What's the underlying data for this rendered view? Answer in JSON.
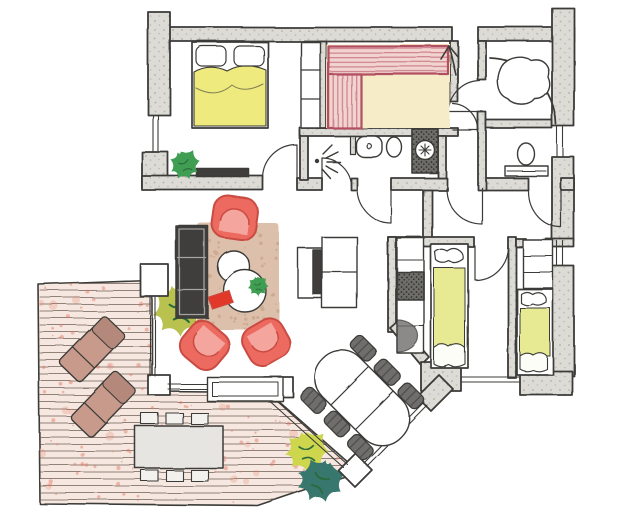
{
  "figure": {
    "kind": "hand-drawn apartment floor plan",
    "style": "pencil sketch with colored-pencil furniture, no text labels"
  },
  "palette": {
    "paper": "#ffffff",
    "ink": "#3b3a38",
    "wallFill": "#dcdbd6",
    "wallDot": "#b9b7b0",
    "bedYellow": "#eeea7d",
    "kidsBedYellow": "#e7ea93",
    "blanketWhite": "#fdfdf8",
    "saunaEdge": "#b24f63",
    "saunaBench": "#f0d4cd",
    "saunaStripe": "#cf8090",
    "saunaFloor": "#f7ecc8",
    "chairRed": "#ec6a5f",
    "chairRedDark": "#c94b42",
    "chairSeat": "#f4a9a0",
    "rug": "#dcc0ab",
    "rugSpeck": "#c19a7f",
    "tvDark": "#3f3e3c",
    "tvLine": "#a5a49f",
    "deckTint": "#f6e8e0",
    "deckLine": "#6f6057",
    "deckSpeck": "#e2735f",
    "loungerFill": "#c89a8b",
    "loungerDark": "#b5887b",
    "outTable": "#e6e5e1",
    "outChair": "#f2f1ed",
    "diningChair": "#6f6e6c",
    "plantGreen": "#3f9e52",
    "plantOlive": "#b9c24f",
    "plantTeal": "#39776d",
    "plantYellow": "#cdd64e",
    "plantDark": "#2c6b3c",
    "bookRed": "#e2382c",
    "hatchDark": "#6e6d69",
    "hatchDot": "#2f2e2c"
  },
  "deck": {
    "plank_spacing": 7,
    "plank_top": 283,
    "plank_bottom": 503,
    "plank_left": 40,
    "plank_right": 358,
    "speck_count": 240,
    "seed": 11
  },
  "rug": {
    "x": 197,
    "y": 223,
    "w": 82,
    "h": 106,
    "speck_count": 90,
    "seed": 5
  },
  "objects": [
    "double-bed",
    "bedroom-wardrobe-shelf",
    "bedroom-plant",
    "bedroom-sideboard",
    "sauna-bench-top",
    "sauna-bench-left",
    "sauna-floor",
    "shower-head",
    "washbasin",
    "toilet",
    "washing-machine",
    "corner-bathtub",
    "wc-toilet",
    "entrance-arrow",
    "hall-cabinet",
    "tv-sideboard",
    "living-rug",
    "coffee-tables",
    "red-book",
    "table-plant",
    "armchair-top",
    "armchair-left",
    "armchair-right",
    "window-bench",
    "dining-table",
    "dining-chairs",
    "kids-wardrobe",
    "kids-bed-1",
    "kids-bed-2",
    "kids-shelf",
    "terrace-deck",
    "sun-lounger-1",
    "sun-lounger-2",
    "outdoor-table",
    "outdoor-chairs",
    "deck-plant-olive",
    "deck-plant-yellow",
    "deck-plant-teal",
    "windows",
    "doors",
    "walls",
    "posts"
  ]
}
